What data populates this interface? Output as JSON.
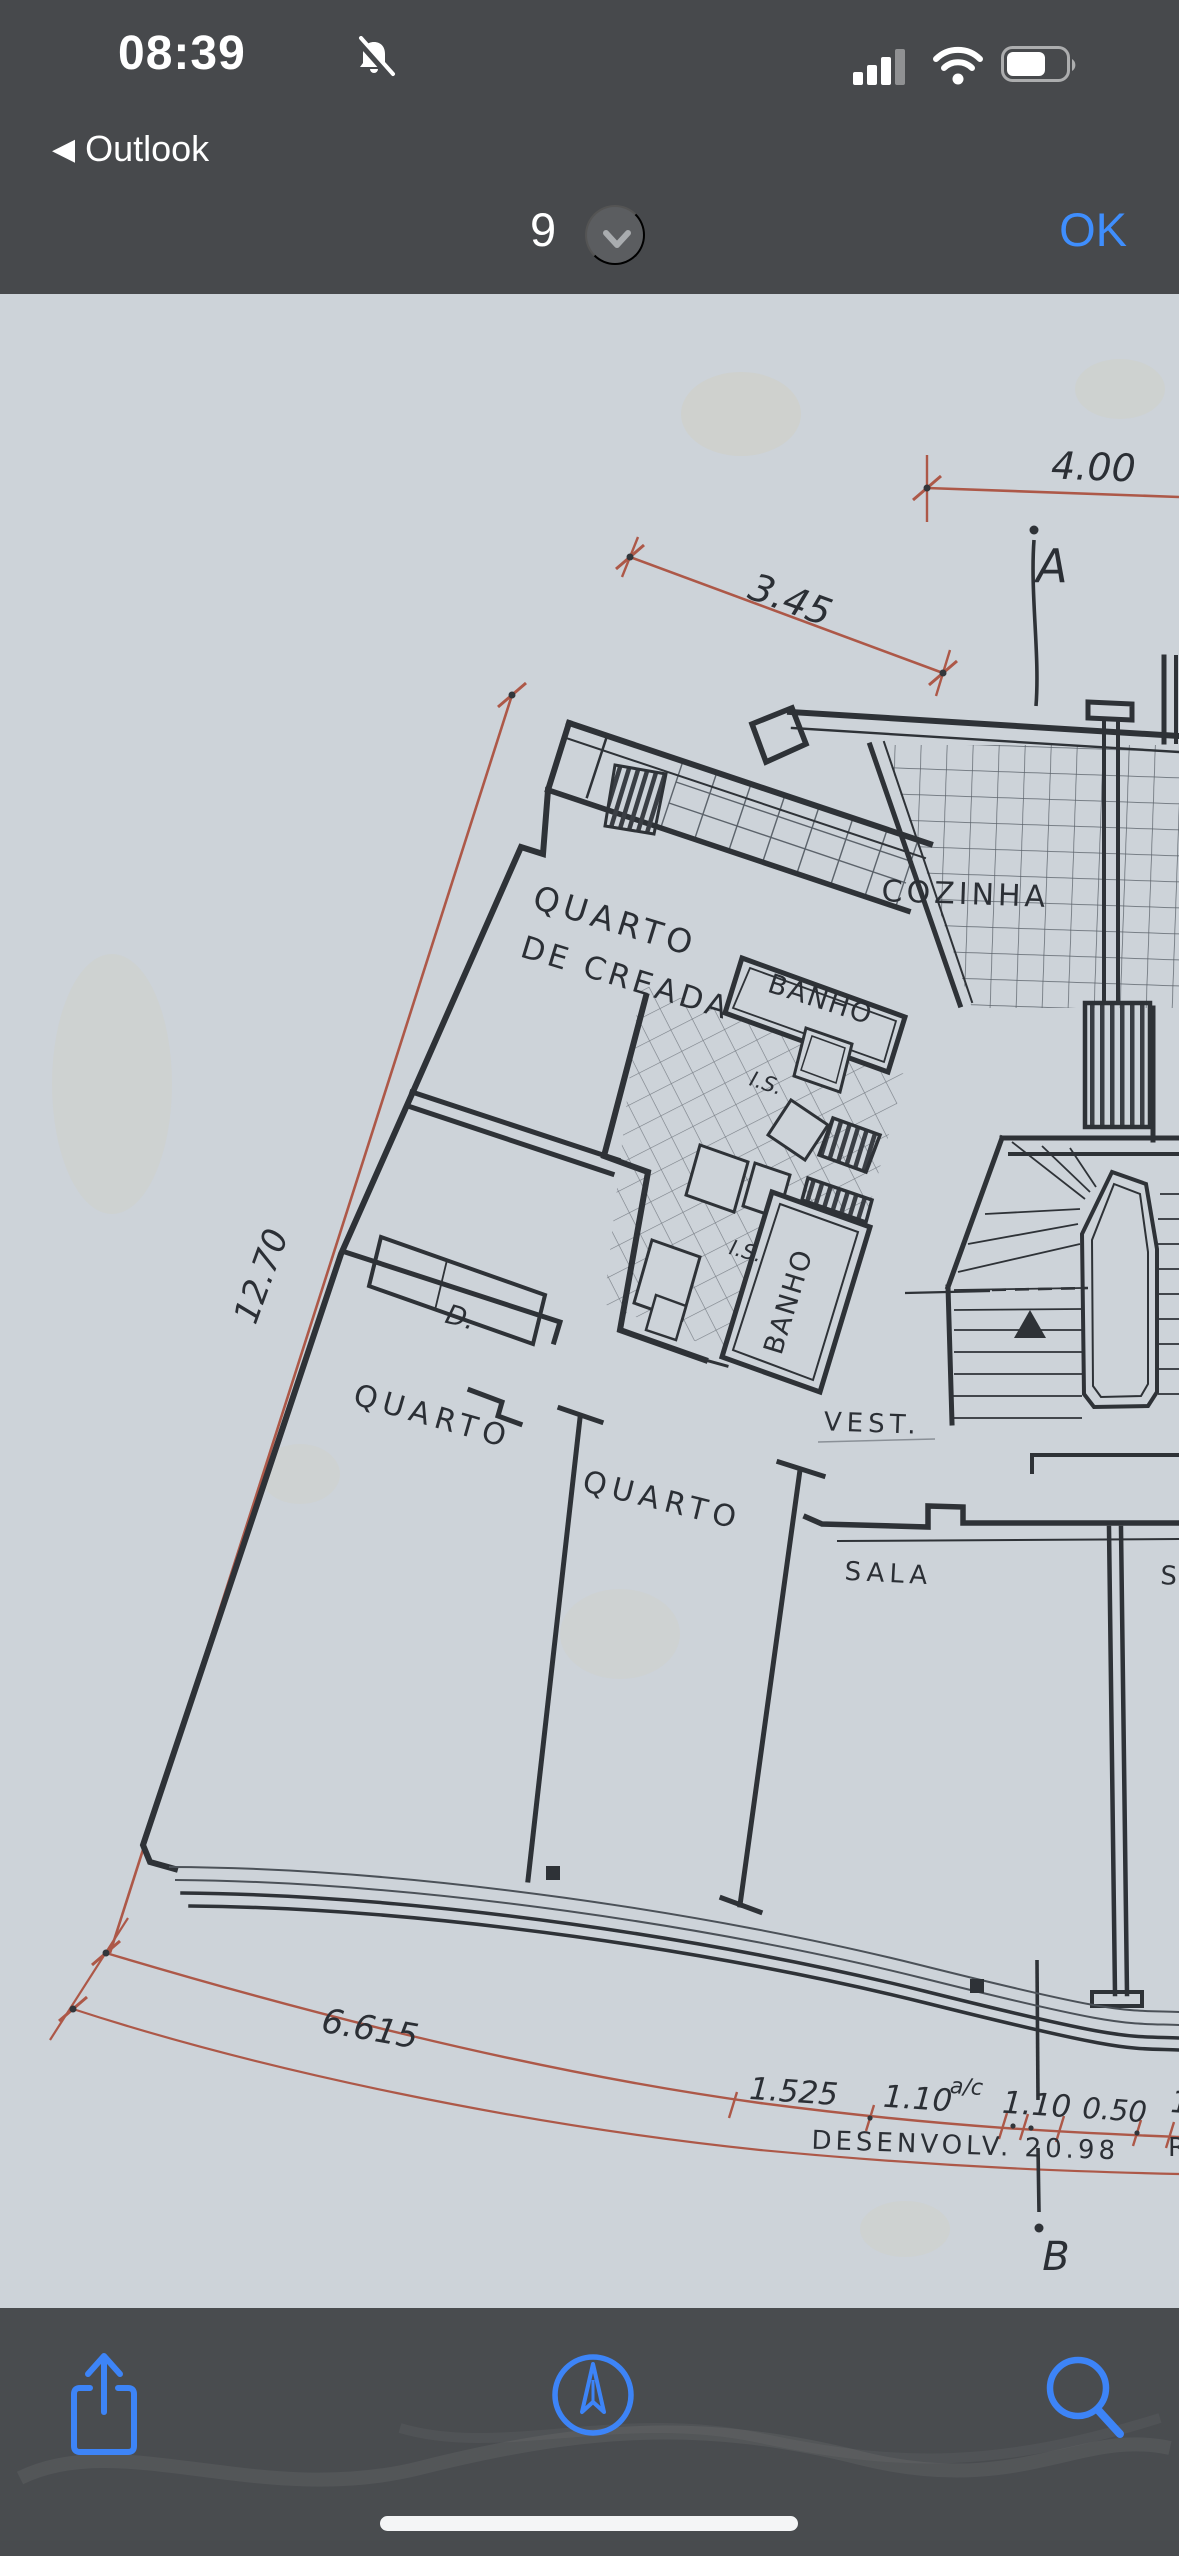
{
  "status_bar": {
    "time": "08:39",
    "back_chevron": "◀",
    "back_app": "Outlook"
  },
  "nav_bar": {
    "page_number": "9",
    "ok_label": "OK"
  },
  "accents": {
    "ios_blue": "#3f8efd",
    "dim_red": "#ad5848",
    "ink": "#2e3237",
    "paper": "#cdd3d9"
  },
  "plan": {
    "title": "PLANTA  DOS  ANDARES",
    "rooms": {
      "cozinha": "COZINHA",
      "quarto_creada_l1": "QUARTO",
      "quarto_creada_l2": "DE CREADA",
      "banho1": "BANHO",
      "banho2": "BANHO",
      "is1": "I.S.",
      "is2": "I.S.",
      "d_closet": "D.",
      "quarto1": "QUARTO",
      "quarto2": "QUARTO",
      "vest": "VEST.",
      "sala": "SALA",
      "sala2_partial": "SA"
    },
    "dimensions": {
      "d400": "4.00",
      "d345": "3.45",
      "d1270": "12.70",
      "d6615": "6.615",
      "d1525": "1.525",
      "d110a": "1.10",
      "dac": "a/c",
      "d110b": "1.10",
      "d050": "0.50",
      "d1_partial": "1",
      "desenvolv": "DESENVOLV.  20.98",
      "r_partial": "R"
    },
    "sections": {
      "a": "A",
      "b": "B"
    }
  }
}
